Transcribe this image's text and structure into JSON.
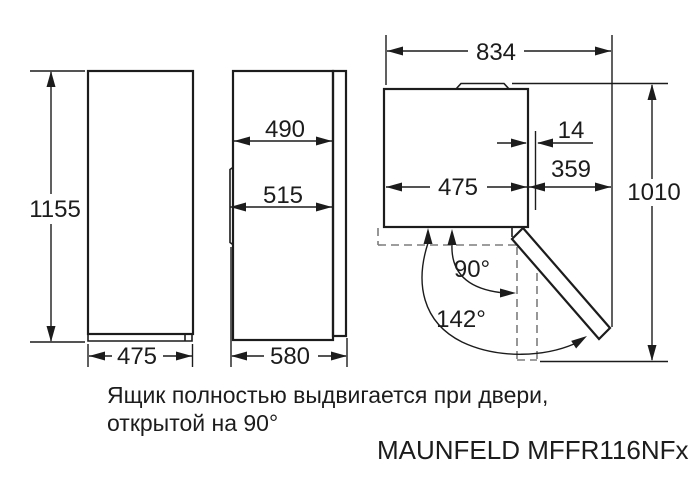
{
  "figure": {
    "labels": {
      "height": "1155",
      "front_width": "475",
      "side_depth_body": "490",
      "side_depth_door": "515",
      "side_depth_total": "580",
      "top_total_width": "834",
      "top_body_width": "475",
      "top_door_offset": "14",
      "top_door_swing": "359",
      "top_total_depth": "1010",
      "angle_open_90": "90°",
      "angle_open_142": "142°"
    },
    "note_line1": "Ящик полностью выдвигается при двери,",
    "note_line2": "открытой на 90°",
    "model": "MAUNFELD MFFR116NFx",
    "colors": {
      "line": "#1c1c1c",
      "dashed_line": "#7d7d7d",
      "background": "#ffffff",
      "text": "#1c1c1c"
    }
  }
}
